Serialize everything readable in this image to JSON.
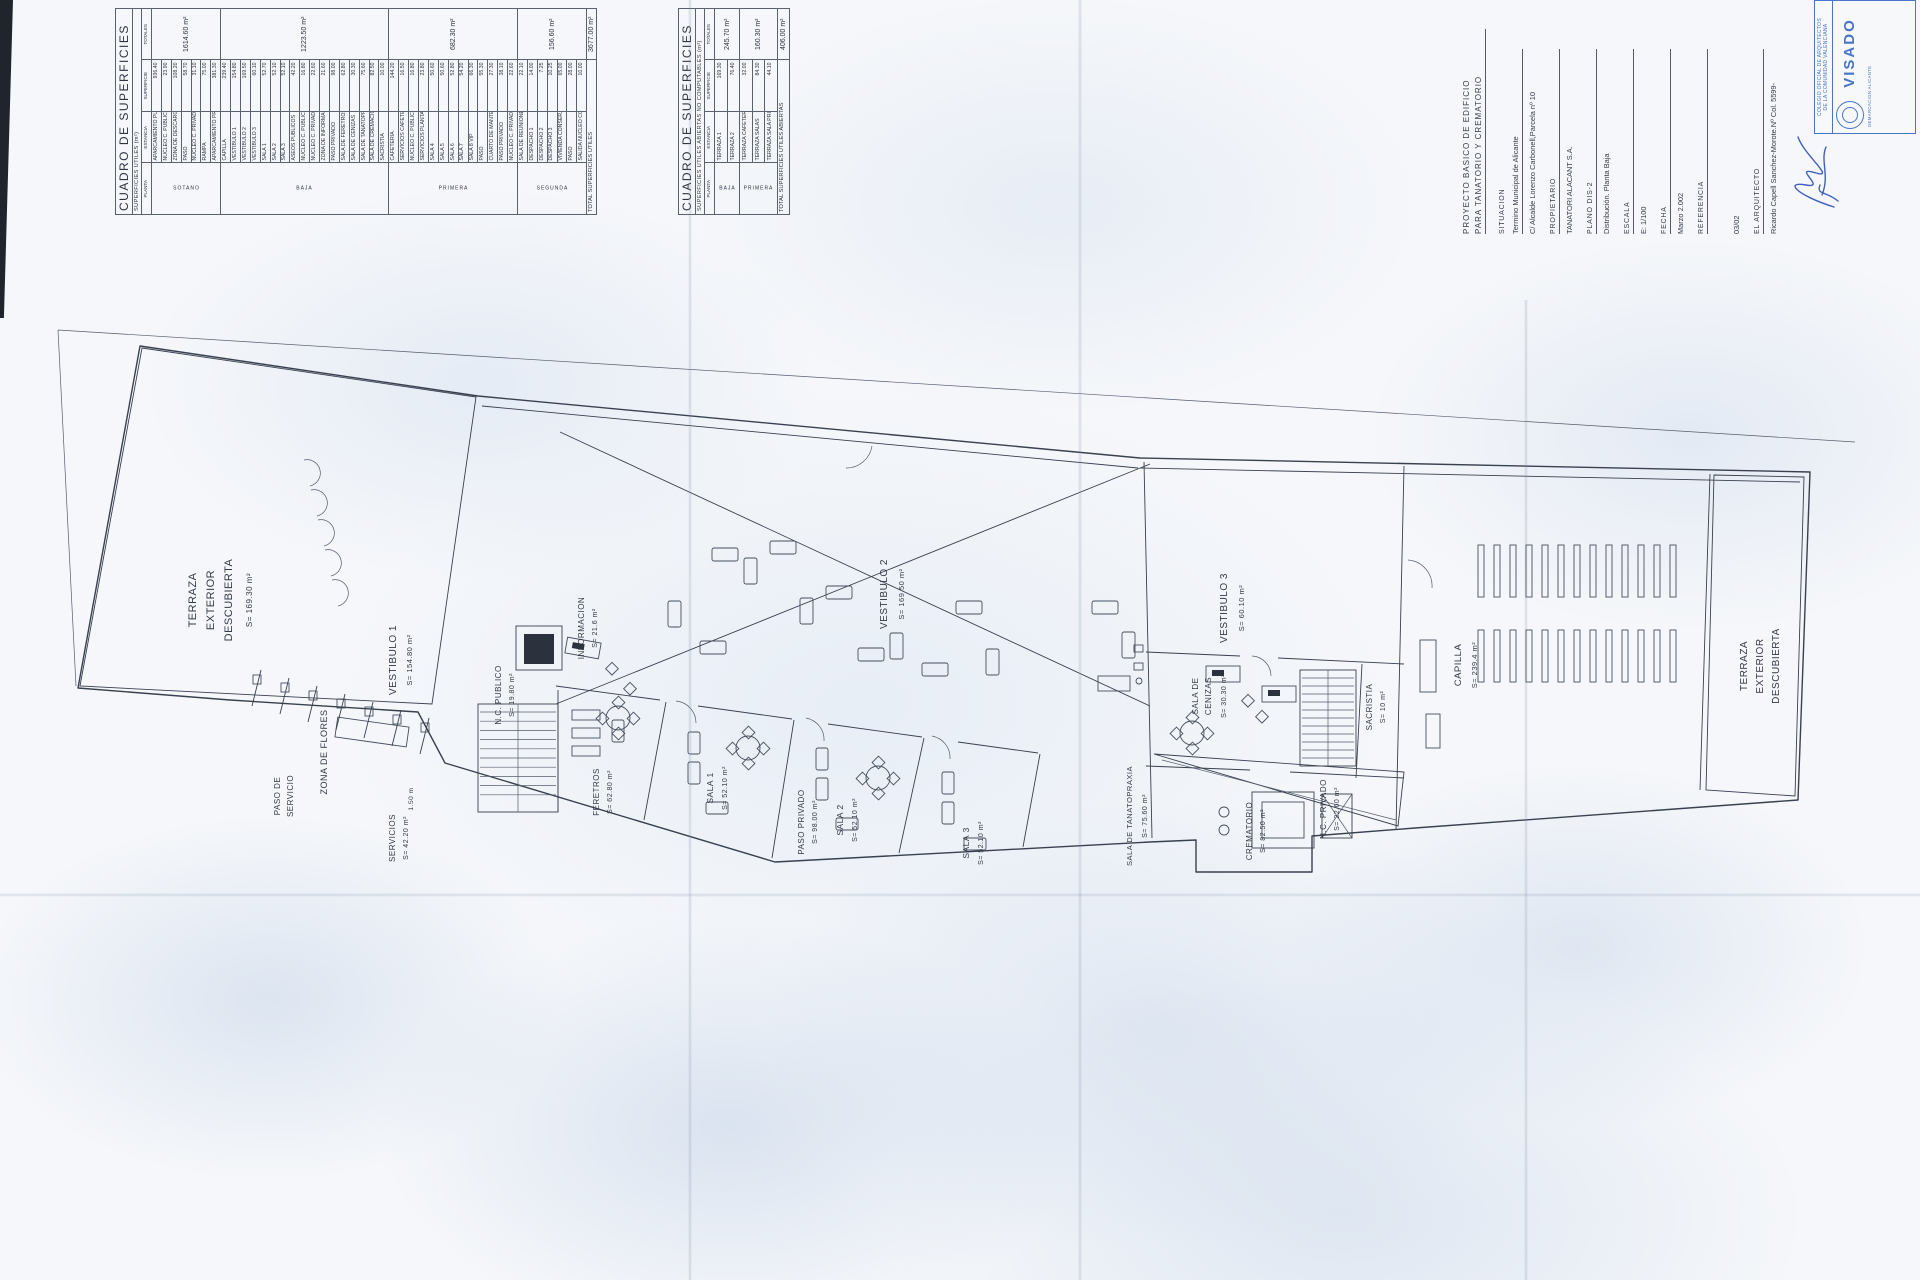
{
  "tables": [
    {
      "title": "CUADRO DE SUPERFICIES",
      "subtitle": "SUPERFICIES UTILES (m²)",
      "headers": [
        "PLANTA",
        "ESTANCIA",
        "SUPERFICIE",
        "TOTALES"
      ],
      "groups": [
        {
          "planta": "SOTANO",
          "rows": [
            [
              "APARCAMIENTO PUBLICO",
              "936.40"
            ],
            [
              "NUCLEO C. PUBLICO",
              "23.90"
            ],
            [
              "ZONA DE DESCARGA",
              "108.20"
            ],
            [
              "PASO",
              "58.70"
            ],
            [
              "NUCLEO C. PRIVADO",
              "31.10"
            ],
            [
              "RAMPA",
              "75.00"
            ],
            [
              "APARCAMIENTO PRIVADO",
              "381.30"
            ]
          ],
          "total": "1614.60 m²"
        },
        {
          "planta": "BAJA",
          "rows": [
            [
              "CAPILLA",
              "239.40"
            ],
            [
              "VESTIBULO 1",
              "154.80"
            ],
            [
              "VESTIBULO 2",
              "169.50"
            ],
            [
              "VESTIBULO 3",
              "60.10"
            ],
            [
              "SALA 1",
              "52.70"
            ],
            [
              "SALA 2",
              "52.10"
            ],
            [
              "SALA 3",
              "52.10"
            ],
            [
              "ASEOS PUBLICOS",
              "42.20"
            ],
            [
              "NUCLEO C. PUBLICO",
              "16.80"
            ],
            [
              "NUCLEO C. PRIVADO",
              "22.60"
            ],
            [
              "ZONA DE INFORMACION",
              "21.60"
            ],
            [
              "PASO PRIVADO",
              "98.00"
            ],
            [
              "SALA DE FERETROS",
              "62.80"
            ],
            [
              "SALA DE CENIZAS",
              "30.30"
            ],
            [
              "SALA DE TANATOPRAXIA",
              "75.60"
            ],
            [
              "SALA DE CREMACION",
              "82.50"
            ],
            [
              "SACRISTIA",
              "10.00"
            ]
          ],
          "total": "1223.50 m²"
        },
        {
          "planta": "PRIMERA",
          "rows": [
            [
              "CAFETERIA",
              "144.20"
            ],
            [
              "SERVICIOS CAFETERIA",
              "16.50"
            ],
            [
              "NUCLEO C. PUBLICO",
              "16.80"
            ],
            [
              "SERVICIOS PLANTA",
              "23.80"
            ],
            [
              "SALA 4",
              "50.60"
            ],
            [
              "SALA 5",
              "50.60"
            ],
            [
              "SALA 6",
              "52.80"
            ],
            [
              "SALA 7",
              "54.20"
            ],
            [
              "SALA 8 VIP",
              "66.30"
            ],
            [
              "PASO",
              "55.30"
            ],
            [
              "CUARTO DE MANTENIMIENTO",
              "27.30"
            ],
            [
              "PASO PRIVADO",
              "38.10"
            ],
            [
              "NUCLEO C. PRIVADO",
              "22.60"
            ]
          ],
          "total": "682.30 m²"
        },
        {
          "planta": "SEGUNDA",
          "rows": [
            [
              "SALA DE REUNIONES",
              "22.10"
            ],
            [
              "DESPACHO 1",
              "14.00"
            ],
            [
              "DESPACHO 2",
              "7.25"
            ],
            [
              "DESPACHO 3",
              "10.25"
            ],
            [
              "VIVIENDA CONSERJE",
              "65.00"
            ],
            [
              "PASO",
              "28.00"
            ],
            [
              "SALIDA NUCLEO COMUNITARIO",
              "10.00"
            ]
          ],
          "total": "156.60 m²"
        }
      ],
      "total_label": "TOTAL SUPERFICIES UTILES",
      "total_value": "3677.00 m²"
    },
    {
      "title": "CUADRO DE SUPERFICIES",
      "subtitle": "SUPERFICIES UTILES ABIERTAS  NO COMPUTABLES (m²)",
      "headers": [
        "PLANTA",
        "ESTANCIA",
        "SUPERFICIE",
        "TOTALES"
      ],
      "groups": [
        {
          "planta": "BAJA",
          "rows": [
            [
              "TERRAZA 1",
              "169.30"
            ],
            [
              "TERRAZA 2",
              "76.40"
            ]
          ],
          "total": "245.70 m²"
        },
        {
          "planta": "PRIMERA",
          "rows": [
            [
              "TERRAZA CAFETERIA",
              "32.00"
            ],
            [
              "TERRAZA SALAS",
              "84.30"
            ],
            [
              "TERRAZA SALA PRIVADA",
              "44.10"
            ]
          ],
          "total": "160.30 m²"
        }
      ],
      "total_label": "TOTAL SUPERFICIES UTILES ABIERTAS",
      "total_value": "406.00 m²"
    }
  ],
  "title_block": {
    "lines": [
      {
        "text": "PROYECTO BASICO DE EDIFICIO",
        "kind": "name"
      },
      {
        "text": "PARA TANATORIO Y CREMATORIO",
        "kind": "name2"
      },
      {
        "text": "SITUACION",
        "kind": "label"
      },
      {
        "text": "Termino Municipal de Alicante",
        "kind": "value-u"
      },
      {
        "text": "C/ Alcalde Lorenzo Carbonell,Parcela nº 10",
        "kind": "value"
      },
      {
        "text": "PROPIETARIO",
        "kind": "label-u"
      },
      {
        "text": "TANATORI ALACANT S.A.",
        "kind": "value"
      },
      {
        "text": "PLANO DIS-2",
        "kind": "label-u"
      },
      {
        "text": "Distribución. Planta Baja",
        "kind": "value"
      },
      {
        "text": "ESCALA",
        "kind": "label-u"
      },
      {
        "text": "E: 1/100",
        "kind": "value"
      },
      {
        "text": "FECHA",
        "kind": "label-u"
      },
      {
        "text": "Marzo 2.002",
        "kind": "value"
      },
      {
        "text": "REFERENCIA",
        "kind": "label-u"
      },
      {
        "text": "03/02",
        "kind": "value-gap"
      },
      {
        "text": "EL ARQUITECTO",
        "kind": "label-u"
      },
      {
        "text": "Ricardo Capell Sanchez-Morote.Nº Col. 5599-",
        "kind": "value"
      }
    ],
    "stamp": {
      "line1": "COLEGIO OFICIAL DE ARQUITECTOS",
      "line2": "DE LA COMUNIDAD VALENCIANA",
      "big": "VISADO",
      "sub": "DEMARCACION ALICANTE",
      "color": "#4a74c9"
    }
  },
  "plan": {
    "labels": [
      {
        "t": "TERRAZA",
        "x": 196,
        "y": 600,
        "s": 11
      },
      {
        "t": "EXTERIOR",
        "x": 214,
        "y": 600,
        "s": 11
      },
      {
        "t": "DESCUBIERTA",
        "x": 232,
        "y": 600,
        "s": 11
      },
      {
        "t": "S= 169.30 m²",
        "x": 252,
        "y": 600,
        "s": 8
      },
      {
        "t": "VESTIBULO 1",
        "x": 396,
        "y": 660,
        "s": 10
      },
      {
        "t": "S= 154.80 m²",
        "x": 412,
        "y": 660,
        "s": 7.5
      },
      {
        "t": "ZONA DE FLORES",
        "x": 327,
        "y": 752,
        "s": 9
      },
      {
        "t": "N.C. PUBLICO",
        "x": 501,
        "y": 695,
        "s": 8
      },
      {
        "t": "S= 19.80 m²",
        "x": 514,
        "y": 695,
        "s": 7
      },
      {
        "t": "SERVICIOS",
        "x": 395,
        "y": 838,
        "s": 8
      },
      {
        "t": "S= 42.20 m²",
        "x": 408,
        "y": 838,
        "s": 7
      },
      {
        "t": "INFORMACION",
        "x": 584,
        "y": 628,
        "s": 8
      },
      {
        "t": "S= 21.6 m²",
        "x": 597,
        "y": 628,
        "s": 7
      },
      {
        "t": "FERETROS",
        "x": 599,
        "y": 792,
        "s": 8
      },
      {
        "t": "S= 62.80 m²",
        "x": 612,
        "y": 792,
        "s": 7
      },
      {
        "t": "SALA 1",
        "x": 713,
        "y": 788,
        "s": 8.5
      },
      {
        "t": "S= 52.10 m²",
        "x": 727,
        "y": 788,
        "s": 7
      },
      {
        "t": "SALA 2",
        "x": 843,
        "y": 820,
        "s": 8.5
      },
      {
        "t": "S= 52.10 m²",
        "x": 857,
        "y": 820,
        "s": 7
      },
      {
        "t": "SALA 3",
        "x": 969,
        "y": 843,
        "s": 8.5
      },
      {
        "t": "S= 52.10 m²",
        "x": 983,
        "y": 843,
        "s": 7
      },
      {
        "t": "VESTIBULO 2",
        "x": 887,
        "y": 594,
        "s": 10
      },
      {
        "t": "S= 169.50 m²",
        "x": 904,
        "y": 594,
        "s": 7.5
      },
      {
        "t": "VESTIBULO 3",
        "x": 1227,
        "y": 608,
        "s": 10
      },
      {
        "t": "S= 60.10 m²",
        "x": 1244,
        "y": 608,
        "s": 7.5
      },
      {
        "t": "SALA DE",
        "x": 1198,
        "y": 696,
        "s": 8
      },
      {
        "t": "CENIZAS",
        "x": 1211,
        "y": 696,
        "s": 8
      },
      {
        "t": "S= 30.30 m²",
        "x": 1226,
        "y": 696,
        "s": 7
      },
      {
        "t": "SACRISTIA",
        "x": 1372,
        "y": 707,
        "s": 8
      },
      {
        "t": "S= 10 m²",
        "x": 1385,
        "y": 707,
        "s": 7
      },
      {
        "t": "CAPILLA",
        "x": 1461,
        "y": 665,
        "s": 9.5
      },
      {
        "t": "S= 239.4 m²",
        "x": 1477,
        "y": 665,
        "s": 7.5
      },
      {
        "t": "CREMATORIO",
        "x": 1252,
        "y": 831,
        "s": 8
      },
      {
        "t": "S= 82.50 m²",
        "x": 1265,
        "y": 831,
        "s": 7
      },
      {
        "t": "N.C. PRIVADO",
        "x": 1326,
        "y": 809,
        "s": 8
      },
      {
        "t": "S= 22.60 m²",
        "x": 1339,
        "y": 809,
        "s": 7
      },
      {
        "t": "SALA DE TANATOPRAXIA",
        "x": 1132,
        "y": 816,
        "s": 7.5
      },
      {
        "t": "S= 75.60 m²",
        "x": 1147,
        "y": 816,
        "s": 7
      },
      {
        "t": "PASO DE",
        "x": 280,
        "y": 796,
        "s": 8
      },
      {
        "t": "SERVICIO",
        "x": 293,
        "y": 796,
        "s": 8
      },
      {
        "t": "PASO PRIVADO",
        "x": 804,
        "y": 822,
        "s": 8
      },
      {
        "t": "S= 98.00 m²",
        "x": 817,
        "y": 822,
        "s": 7
      },
      {
        "t": "TERRAZA",
        "x": 1747,
        "y": 666,
        "s": 10
      },
      {
        "t": "EXTERIOR",
        "x": 1763,
        "y": 666,
        "s": 10
      },
      {
        "t": "DESCUBIERTA",
        "x": 1779,
        "y": 666,
        "s": 10
      },
      {
        "t": "1.50 m",
        "x": 413,
        "y": 799,
        "s": 6.5
      }
    ]
  }
}
